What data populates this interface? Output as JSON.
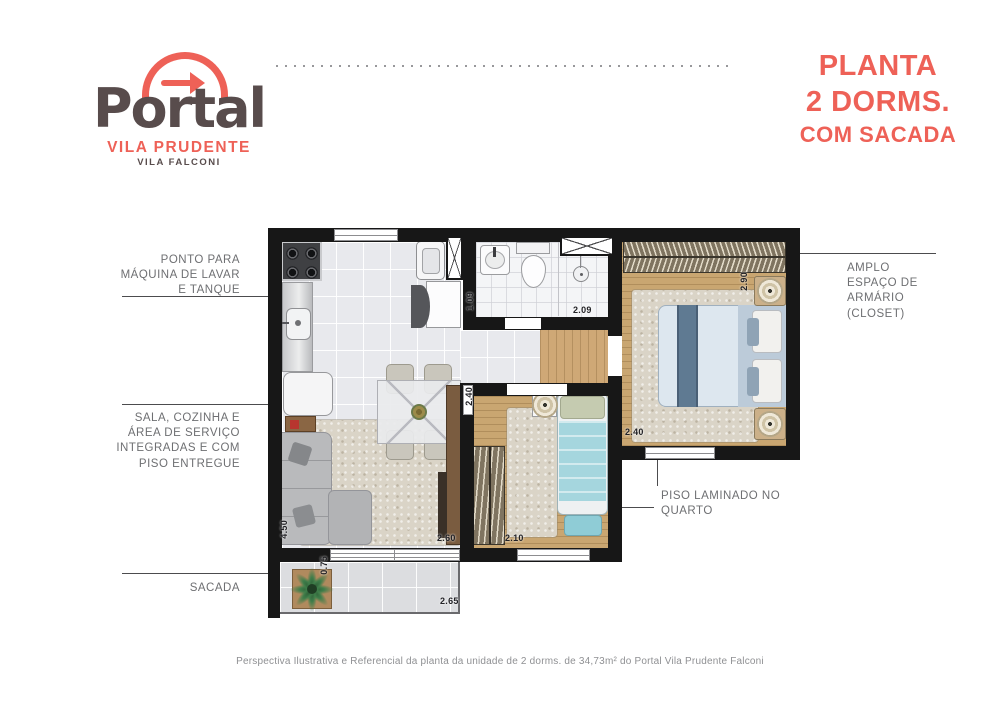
{
  "logo": {
    "brand": "Portal",
    "location": "VILA PRUDENTE",
    "development": "VILA FALCONI"
  },
  "title": {
    "line1": "PLANTA",
    "line2": "2 DORMS.",
    "line3": "COM SACADA"
  },
  "callouts": {
    "laundry": "PONTO PARA\nMÁQUINA DE LAVAR\nE TANQUE",
    "living": "SALA, COZINHA E\nÁREA DE SERVIÇO\nINTEGRADAS E COM\nPISO ENTREGUE",
    "balcony": "SACADA",
    "closet": "AMPLO\nESPAÇO DE\nARMÁRIO\n(CLOSET)",
    "laminate_floor": "PISO LAMINADO NO\nQUARTO"
  },
  "dimensions": {
    "bathroom_width": "1.09",
    "bathroom_length": "2.09",
    "master_length": "2.90",
    "master_width": "2.40",
    "bedroom2_width": "2.40",
    "bedroom2_length": "2.10",
    "living_length": "4.50",
    "living_width": "2.60",
    "balcony_width": "0.75",
    "balcony_length": "2.65"
  },
  "footer": {
    "disclaimer": "Perspectiva Ilustrativa e Referencial da planta da unidade de 2 dorms. de 34,73m² do Portal Vila Prudente Falconi"
  },
  "colors": {
    "coral": "#EE6157",
    "brand_dark": "#584C4C",
    "label_gray": "#6E6F72",
    "wall_black": "#171717",
    "wood": "#C9A671",
    "tile": "#E8E9ED",
    "bed_blue": "#5F7A92"
  }
}
